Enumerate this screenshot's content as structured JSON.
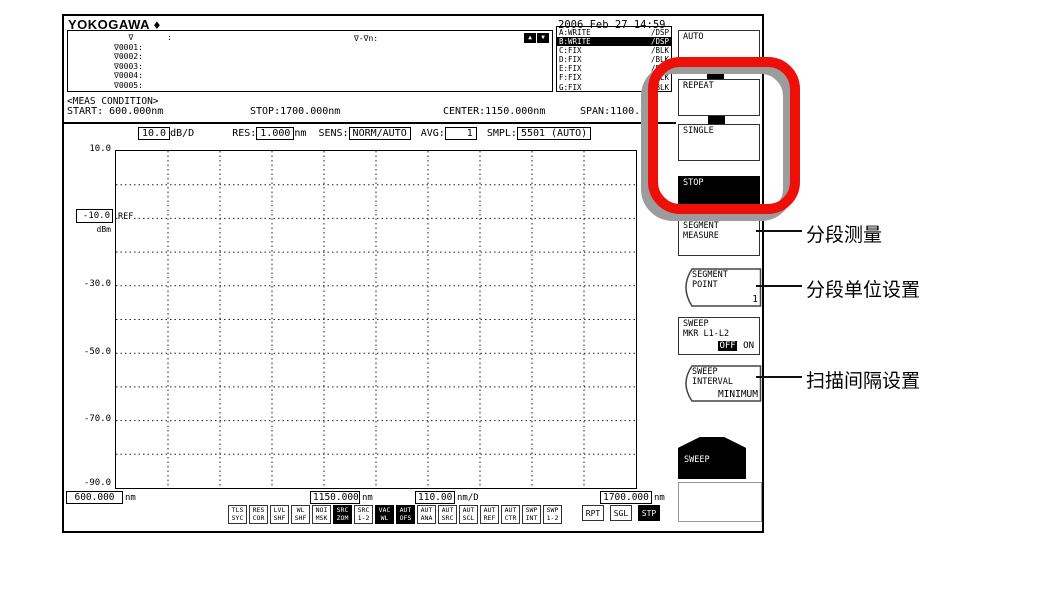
{
  "header": {
    "brand": "YOKOGAWA",
    "brand_mark": "♦",
    "datetime": "2006 Feb 27 14:59"
  },
  "marker_panel": {
    "rows": [
      "   ∇       :",
      "∇0001:",
      "∇0002:",
      "∇0003:",
      "∇0004:",
      "∇0005:"
    ],
    "delta_label": "∇-∇n:",
    "up_icon": "▲",
    "down_icon": "▼"
  },
  "trace_panel": {
    "rows": [
      {
        "name": "A:WRITE",
        "mode": "/DSP",
        "active": false
      },
      {
        "name": "B:WRITE",
        "mode": "/DSP",
        "active": true
      },
      {
        "name": "C:FIX",
        "mode": "/BLK",
        "active": false
      },
      {
        "name": "D:FIX",
        "mode": "/BLK",
        "active": false
      },
      {
        "name": "E:FIX",
        "mode": "/BLK",
        "active": false
      },
      {
        "name": "F:FIX",
        "mode": "/BLK",
        "active": false
      },
      {
        "name": "G:FIX",
        "mode": "/BLK",
        "active": false
      }
    ]
  },
  "meas_condition": {
    "title": "<MEAS CONDITION>",
    "fields": [
      {
        "label": "START: ",
        "value": "600.000nm"
      },
      {
        "label": "STOP:",
        "value": "1700.000nm"
      },
      {
        "label": "CENTER:",
        "value": "1150.000nm"
      },
      {
        "label": "SPAN:",
        "value": "1100.0nm"
      }
    ]
  },
  "settings_row": {
    "level_scale": {
      "value": "10.0",
      "unit": "dB/D"
    },
    "res": {
      "label": "RES:",
      "value": "1.000",
      "unit": "nm"
    },
    "sens": {
      "label": "SENS:",
      "value": "NORM/AUTO"
    },
    "avg": {
      "label": "AVG:",
      "value": "1"
    },
    "smpl": {
      "label": "SMPL:",
      "value": "5501 (AUTO)"
    }
  },
  "graph": {
    "ref_label": "REF",
    "y_unit": "dBm",
    "y_ticks": [
      "10.0",
      "-10.0",
      "-30.0",
      "-50.0",
      "-70.0",
      "-90.0"
    ],
    "db_per_div": 10,
    "divisions_x": 10,
    "divisions_y": 10,
    "x_axis": {
      "start": "600.000",
      "start_unit": "nm",
      "center": "1150.000",
      "center_unit": "nm",
      "scale": "110.00",
      "scale_unit": "nm/D",
      "stop": "1700.000",
      "stop_unit": "nm"
    }
  },
  "status_bar": {
    "indicators": [
      {
        "line1": "TLS",
        "line2": "SYC",
        "active": false
      },
      {
        "line1": "RES",
        "line2": "COR",
        "active": false
      },
      {
        "line1": "LVL",
        "line2": "SHF",
        "active": false
      },
      {
        "line1": "WL",
        "line2": "SHF",
        "active": false
      },
      {
        "line1": "NOI",
        "line2": "MSK",
        "active": false
      },
      {
        "line1": "SRC",
        "line2": "ZOM",
        "active": true
      },
      {
        "line1": "SRC",
        "line2": "1-2",
        "active": false
      },
      {
        "line1": "VAC",
        "line2": "WL",
        "active": true
      },
      {
        "line1": "AUT",
        "line2": "OFS",
        "active": true
      },
      {
        "line1": "AUT",
        "line2": "ANA",
        "active": false
      },
      {
        "line1": "AUT",
        "line2": "SRC",
        "active": false
      },
      {
        "line1": "AUT",
        "line2": "SCL",
        "active": false
      },
      {
        "line1": "AUT",
        "line2": "REF",
        "active": false
      },
      {
        "line1": "AUT",
        "line2": "CTR",
        "active": false
      },
      {
        "line1": "SWP",
        "line2": "INT",
        "active": false
      },
      {
        "line1": "SWP",
        "line2": "1-2",
        "active": false
      }
    ],
    "buttons": [
      {
        "label": "RPT",
        "active": false
      },
      {
        "label": "SGL",
        "active": false
      },
      {
        "label": "STP",
        "active": true
      }
    ]
  },
  "softkeys": {
    "auto": {
      "label": "AUTO"
    },
    "repeat": {
      "label": "REPEAT"
    },
    "single": {
      "label": "SINGLE"
    },
    "stop": {
      "label": "STOP"
    },
    "segment_measure": {
      "line1": "SEGMENT",
      "line2": "MEASURE"
    },
    "segment_point": {
      "line1": "SEGMENT",
      "line2": "POINT",
      "value": "1"
    },
    "sweep_marker": {
      "line1": "SWEEP",
      "line2": "MKR L1-L2",
      "off": "OFF",
      "on": "ON",
      "selected": "OFF"
    },
    "sweep_interval": {
      "line1": "SWEEP",
      "line2": "INTERVAL",
      "value": "MINIMUM"
    },
    "sweep_menu": {
      "label": "SWEEP"
    }
  },
  "annotations": [
    {
      "text": "分段测量"
    },
    {
      "text": "分段单位设置"
    },
    {
      "text": "扫描间隔设置"
    }
  ],
  "colors": {
    "highlight_ring": "#ee1008",
    "ring_shadow": "#9c9c9c",
    "active_bg": "#000000"
  }
}
